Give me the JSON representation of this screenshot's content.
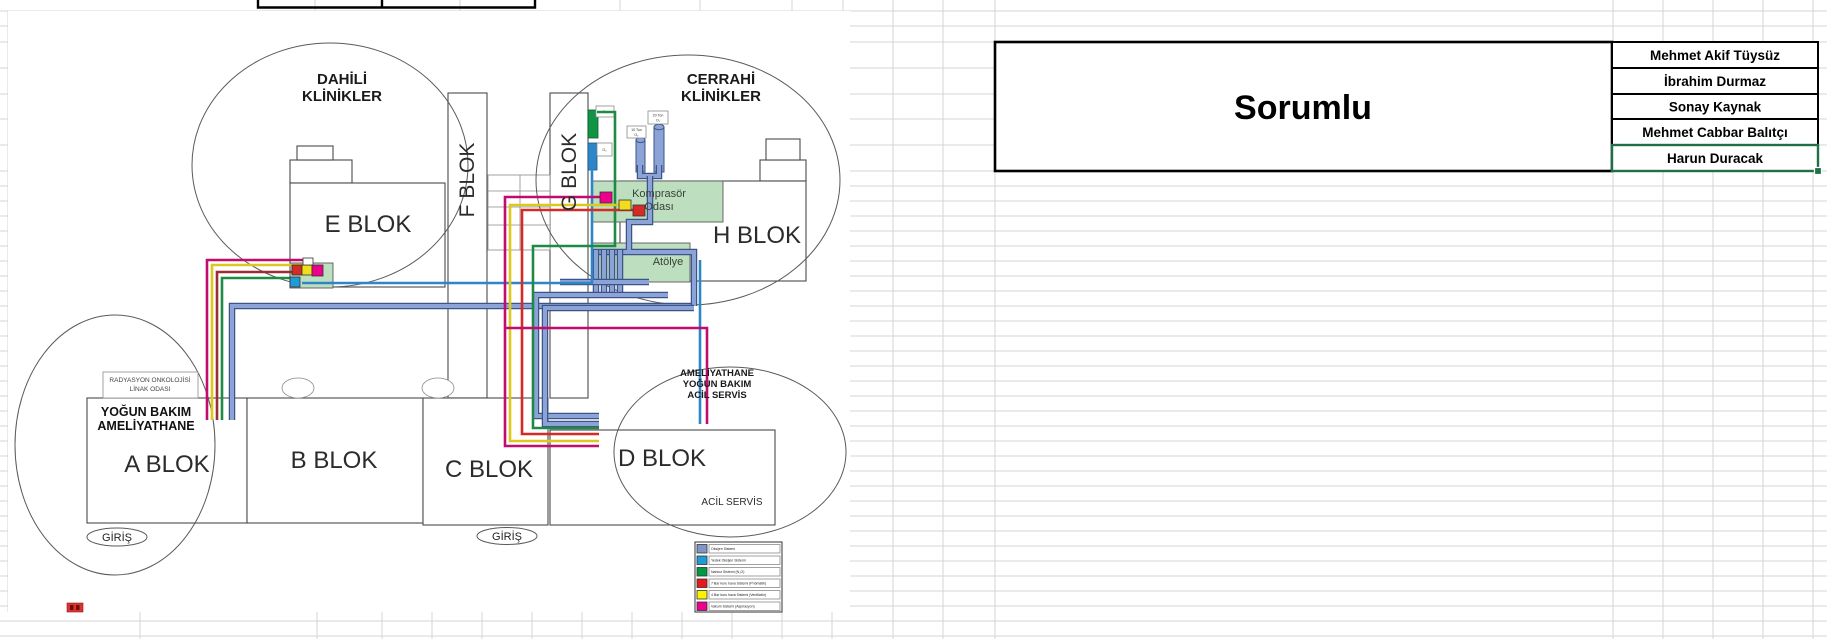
{
  "sheet": {
    "grid_color": "#d4d4d4",
    "selection_color": "#1E7145",
    "background": "#ffffff"
  },
  "responsible_table": {
    "title": "Sorumlu",
    "names": [
      "Mehmet Akif Tüysüz",
      "İbrahim Durmaz",
      "Sonay Kaynak",
      "Mehmet Cabbar Balıtçı",
      "Harun Duracak"
    ]
  },
  "site_plan": {
    "zones": [
      {
        "lines": [
          "DAHİLİ",
          "KLİNİKLER"
        ]
      },
      {
        "lines": [
          "CERRAHİ",
          "KLİNİKLER"
        ]
      }
    ],
    "blocks": [
      "E BLOK",
      "F BLOK",
      "G BLOK",
      "H BLOK",
      "A BLOK",
      "B BLOK",
      "C BLOK",
      "D BLOK"
    ],
    "rooms": {
      "kompresor": {
        "lines": [
          "Komprasör",
          "Odası"
        ]
      },
      "atolye": "Atölye"
    },
    "labels": {
      "radyasyon": {
        "lines": [
          "RADYASYON ONKOLOJİSİ",
          "LİNAK ODASI"
        ]
      },
      "yogun_bakim": {
        "lines": [
          "YOĞUN BAKIM",
          "AMELİYATHANE"
        ]
      },
      "ameliyathane": {
        "lines": [
          "AMELİYATHANE",
          "YOĞUN BAKIM",
          "ACİL SERVİS"
        ]
      },
      "acil_servis": "ACİL SERVİS",
      "giris_left": "GİRİŞ",
      "giris_right": "GİRİŞ"
    },
    "tanks": [
      {
        "lines": [
          "10 Ton",
          "O₂"
        ]
      },
      {
        "lines": [
          "20 Ton",
          "O₂"
        ]
      }
    ],
    "gas_chips": [
      "O₂",
      "O₂"
    ],
    "legend": {
      "items": [
        {
          "label": "Oksijen Sistemi",
          "color": "#8096C8"
        },
        {
          "label": "Yedek Oksijen Sistemi",
          "color": "#1F9CD8"
        },
        {
          "label": "Narkoz Sistemi (N₂O)",
          "color": "#009A44"
        },
        {
          "label": "7 Bar kuru hava Sistemi (Pnömatik)",
          "color": "#E8191C"
        },
        {
          "label": "4 Bar kuru hava Sistemi (Ventilatör)",
          "color": "#FFF200"
        },
        {
          "label": "Vakum Sistemi (Aspirasyon)",
          "color": "#EC008C"
        }
      ]
    }
  }
}
